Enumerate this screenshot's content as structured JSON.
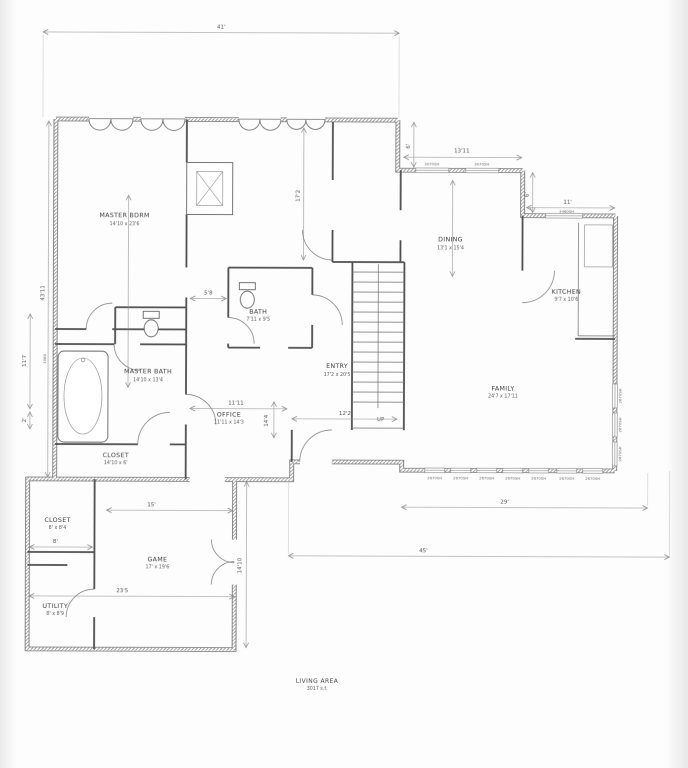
{
  "page": {
    "background": "#fdfdfd",
    "ink": "#4a4a4a"
  },
  "rooms": {
    "master_bdrm": {
      "name": "MASTER BDRM",
      "dims": "14'10 x 23'6"
    },
    "bath": {
      "name": "BATH",
      "dims": "7'11 x 9'5"
    },
    "dining": {
      "name": "DINING",
      "dims": "13'1 x 15'4"
    },
    "kitchen": {
      "name": "KITCHEN",
      "dims": "9'7 x 10'6"
    },
    "family": {
      "name": "FAMILY",
      "dims": "24'7 x 17'11"
    },
    "entry": {
      "name": "ENTRY",
      "dims": "17'2 x 20'5"
    },
    "office": {
      "name": "OFFICE",
      "dims": "11'11 x 14'3"
    },
    "master_bath": {
      "name": "MASTER BATH",
      "dims": "14'10 x 13'4"
    },
    "closet_master": {
      "name": "CLOSET",
      "dims": "14'10 x 6'"
    },
    "closet_small": {
      "name": "CLOSET",
      "dims": "8' x 8'4"
    },
    "game": {
      "name": "GAME",
      "dims": "17' x 19'6"
    },
    "utility": {
      "name": "UTILITY",
      "dims": "8' x 8'9"
    }
  },
  "stairs": {
    "up_label": "UP"
  },
  "area_note": {
    "label": "LIVING AREA",
    "value": "3017 s.f."
  },
  "dimensions": {
    "top_width": "41'",
    "left_overall": "43'11",
    "left_bath": "11'7",
    "left_jog": "2'",
    "door_code": "3068",
    "right_step": "6'",
    "breakfast_width": "13'11",
    "kitchen_step": "6'",
    "kitchen_width": "11'",
    "sitting_height": "17'2",
    "hall_width": "5'8",
    "office_width": "11'11",
    "office_height": "14'4",
    "entry_width": "12'2",
    "game_width": "15'",
    "closet_width": "8'",
    "wing_width": "23'5",
    "game_height": "14'10",
    "family_windows_width": "29'",
    "overall_width": "45'"
  },
  "windows": {
    "upper": [
      "3070SH",
      "3070SH"
    ],
    "kitchen": [
      "3460SH"
    ],
    "family_bottom": [
      "2670SH",
      "2670SH",
      "2670SH",
      "2670SH",
      "2670SH",
      "2670SH",
      "2670SH"
    ],
    "family_right": [
      "2670SH",
      "2670SH",
      "2670SH"
    ]
  }
}
